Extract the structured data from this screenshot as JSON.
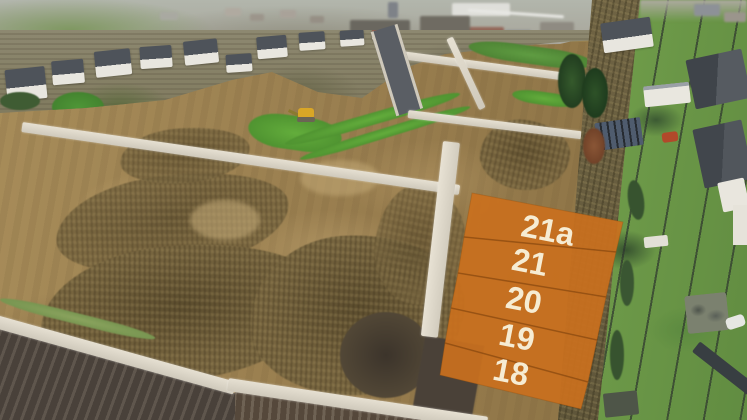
{
  "scene": {
    "description": "Aerial drone photo of a new housing development: graded brown building plots with fresh roads, an excavator, a town skyline at the top and a row of houses with gardens on the right. Five plots are highlighted with an orange overlay."
  },
  "overlay": {
    "accent_color": "#c9701e",
    "divider_color": "#8a4a10",
    "label_color": "#f6ecd3",
    "plots": [
      {
        "id": "21a",
        "label": "21a"
      },
      {
        "id": "21",
        "label": "21"
      },
      {
        "id": "20",
        "label": "20"
      },
      {
        "id": "19",
        "label": "19"
      },
      {
        "id": "18",
        "label": "18"
      }
    ]
  }
}
